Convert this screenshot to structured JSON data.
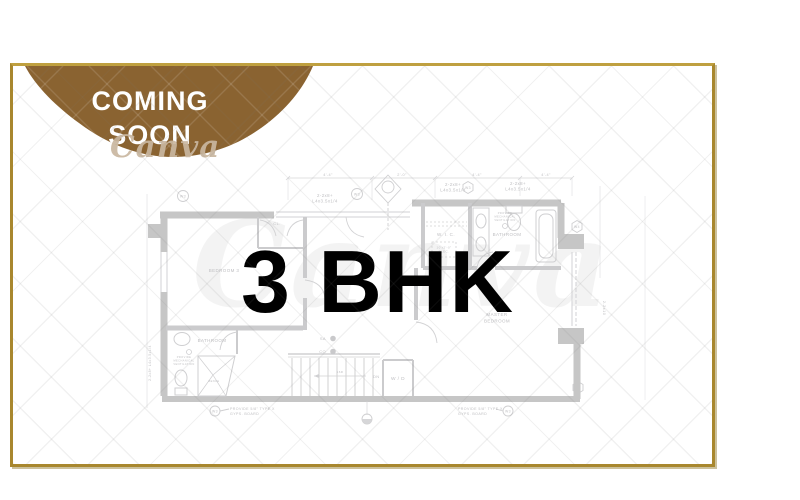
{
  "card": {
    "background": "#ffffff",
    "border_color": "#a8872e"
  },
  "badge": {
    "line1": "COMING",
    "line2": "SOON",
    "fill": "#8a6331",
    "text_color": "#ffffff"
  },
  "watermark": {
    "brand": "Canva"
  },
  "headline": {
    "text": "3 BHK",
    "color": "#000000"
  },
  "floorplan": {
    "ink": "#c6c6c6",
    "rooms": {
      "bedroom3": "BEDROOM 3",
      "closet": "CL.",
      "wic": "W. I. C.",
      "bathroom_top": "BATHROOM",
      "master_line1": "MASTER",
      "master_line2": "BEDROOM",
      "bathroom_left": "BATHROOM",
      "laundry": "W / D"
    },
    "stairs": {
      "down": "DN",
      "risers": "16R",
      "bench": "BENCH"
    },
    "symbols": {
      "w3a": "W3",
      "w3b": "W3",
      "w3c": "W3",
      "w4": "W4",
      "w3d": "W3",
      "w3e": "W3",
      "w3f": "W3",
      "smoke": "SA",
      "co": "CO"
    },
    "beams": {
      "b1a": "2-2x8+",
      "b1b": "L4x3.5x1/4",
      "b2a": "2-2x8+",
      "b2b": "L4x3.5x1/4",
      "b3a": "2-2x8+",
      "b3b": "L4x3.5x1/4",
      "left_vertical": "2-2x8+ L4x3.5x1/4",
      "right_vertical": "2-2x10"
    },
    "notes": {
      "gyps1a": "PROVIDE 5/8\" TYPE X",
      "gyps1b": "GYPS. BOARD",
      "gyps2a": "PROVIDE 5/8\" TYPE X",
      "gyps2b": "GYPS. BOARD",
      "vent1a": "PROVIDE",
      "vent1b": "MECHANICAL",
      "vent1c": "VENTILATION",
      "vent2a": "PROVIDE",
      "vent2b": "MECHANICAL",
      "vent2c": "VENTILATION",
      "elec1": "10'x2'-0\"",
      "elec2": "ELEC."
    },
    "dims": {
      "d1": "4'-4\"",
      "d2": "2'-0\"",
      "d3": "4'-4\"",
      "d4": "4'-4\""
    }
  }
}
